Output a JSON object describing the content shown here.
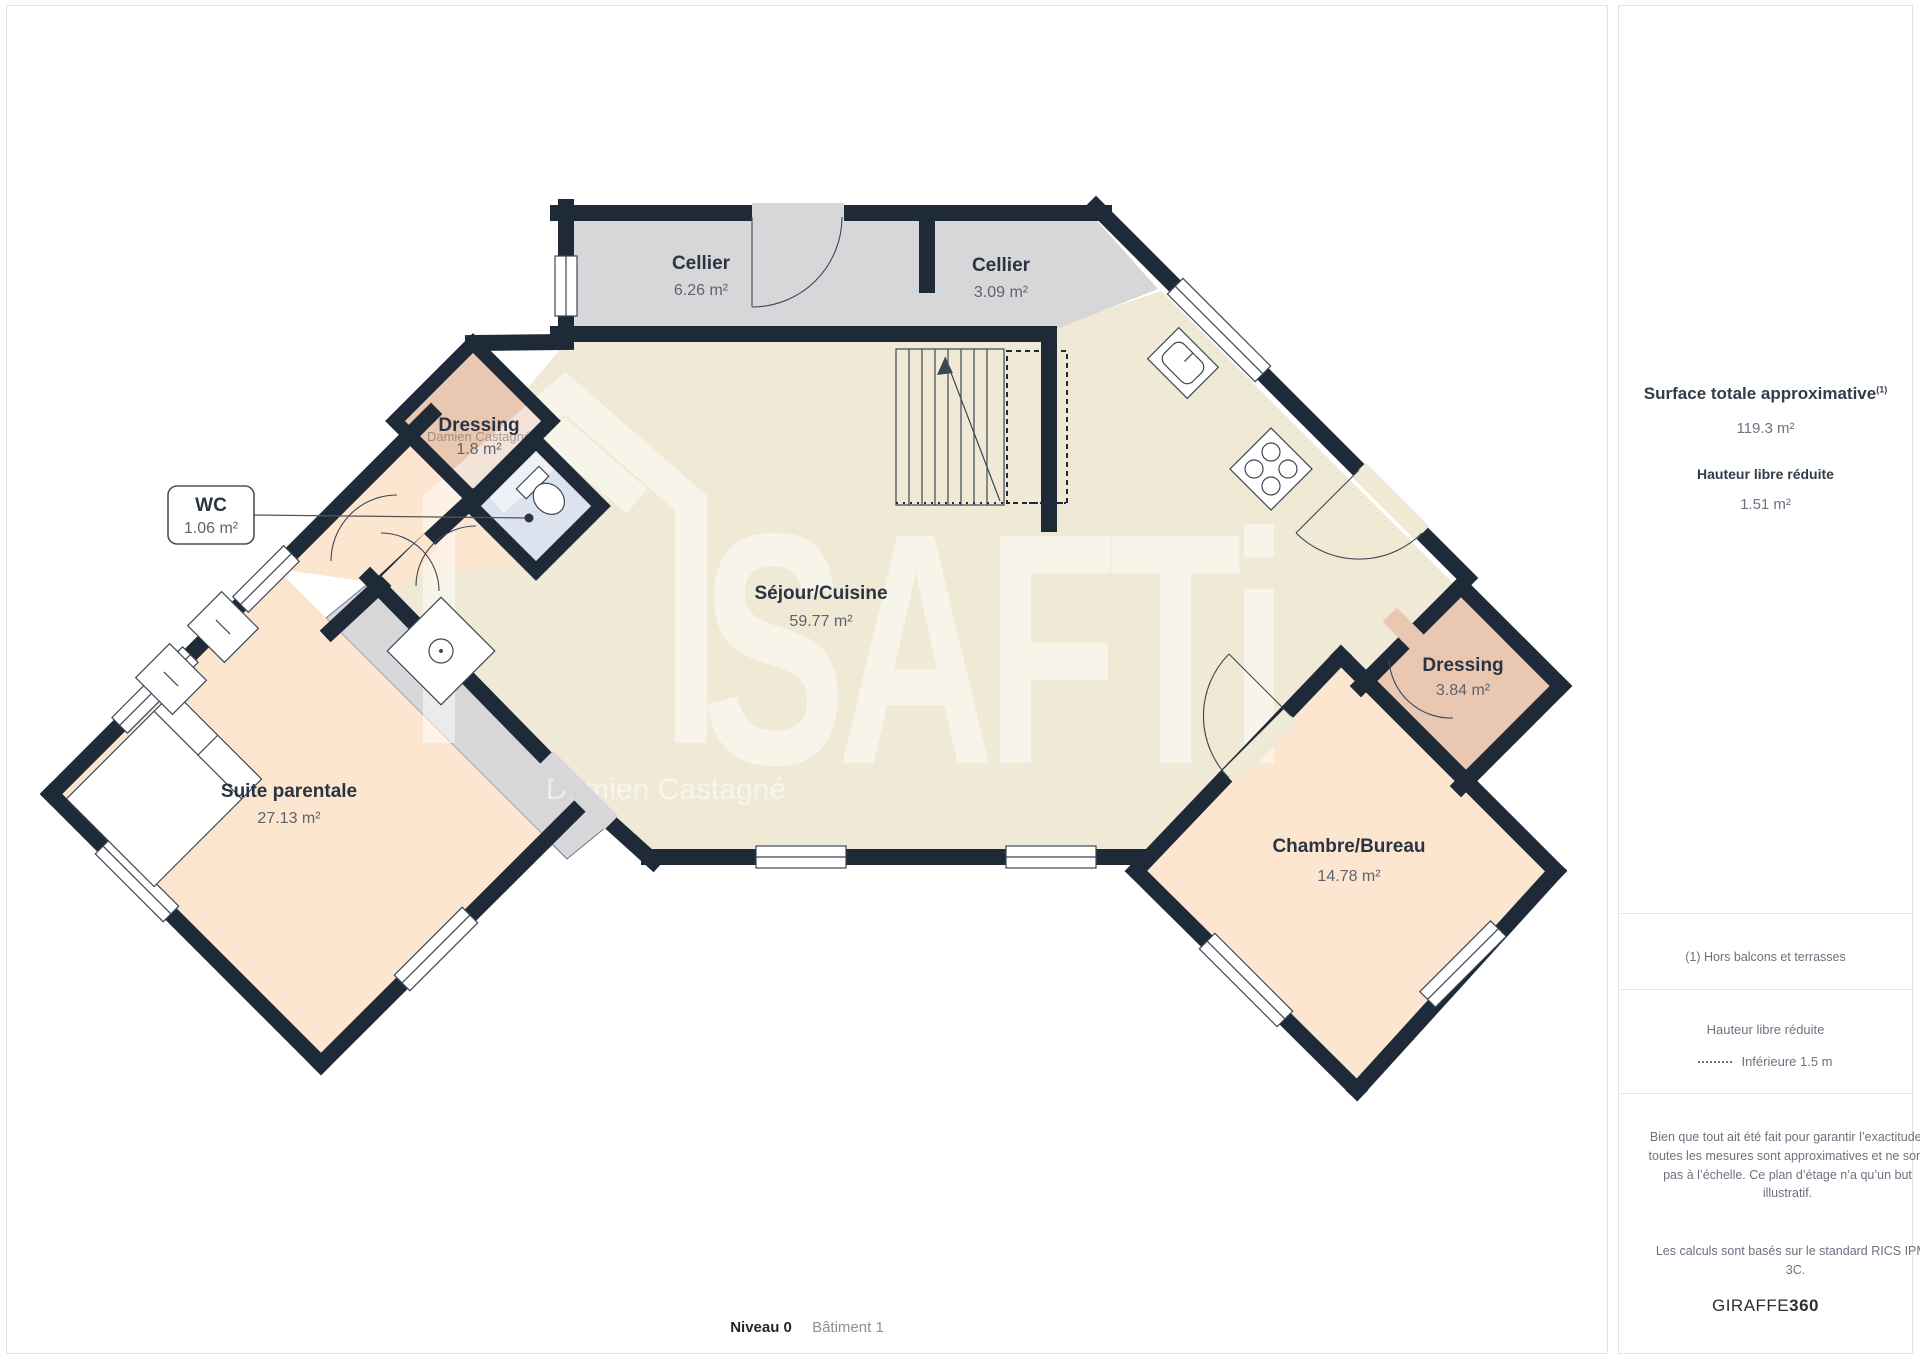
{
  "plan": {
    "level_label": "Niveau 0",
    "building_label": "Bâtiment 1"
  },
  "rooms": [
    {
      "name": "Cellier",
      "area": "6.26 m²"
    },
    {
      "name": "Cellier",
      "area": "3.09 m²"
    },
    {
      "name": "Séjour/Cuisine",
      "area": "59.77 m²"
    },
    {
      "name": "Suite parentale",
      "area": "27.13 m²"
    },
    {
      "name": "Dressing",
      "area": "1.8 m²"
    },
    {
      "name": "WC",
      "area": "1.06 m²"
    },
    {
      "name": "Dressing",
      "area": "3.84 m²"
    },
    {
      "name": "Chambre/Bureau",
      "area": "14.78 m²"
    }
  ],
  "watermark": {
    "brand": "SAFTi",
    "agent": "Damien Castagné"
  },
  "sidebar": {
    "total_title": "Surface totale approximative",
    "total_note_ref": "(1)",
    "total_value": "119.3 m²",
    "reduced_title": "Hauteur libre réduite",
    "reduced_value": "1.51 m²",
    "note": "(1) Hors balcons et terrasses",
    "legend_title": "Hauteur libre réduite",
    "legend_item": "Inférieure 1.5 m",
    "disclaimer": "Bien que tout ait été fait pour garantir l’exactitude, toutes les mesures sont approximatives et ne sont pas à l’échelle. Ce plan d’étage n’a qu’un but illustratif.",
    "standard": "Les calculs sont basés sur le standard RICS IPMS 3C.",
    "brand": "GIRAFFE",
    "brand_suffix": "360"
  },
  "colors": {
    "wall": "#1e2a38",
    "floor_living": "#f0e9d5",
    "floor_cellar": "#d7d7d9",
    "floor_bedroom": "#fde6cf",
    "floor_dressing": "#e9c7b1",
    "floor_wc": "#dde3ee",
    "label_dark": "#2b3442",
    "label_gray": "#5b6470"
  }
}
